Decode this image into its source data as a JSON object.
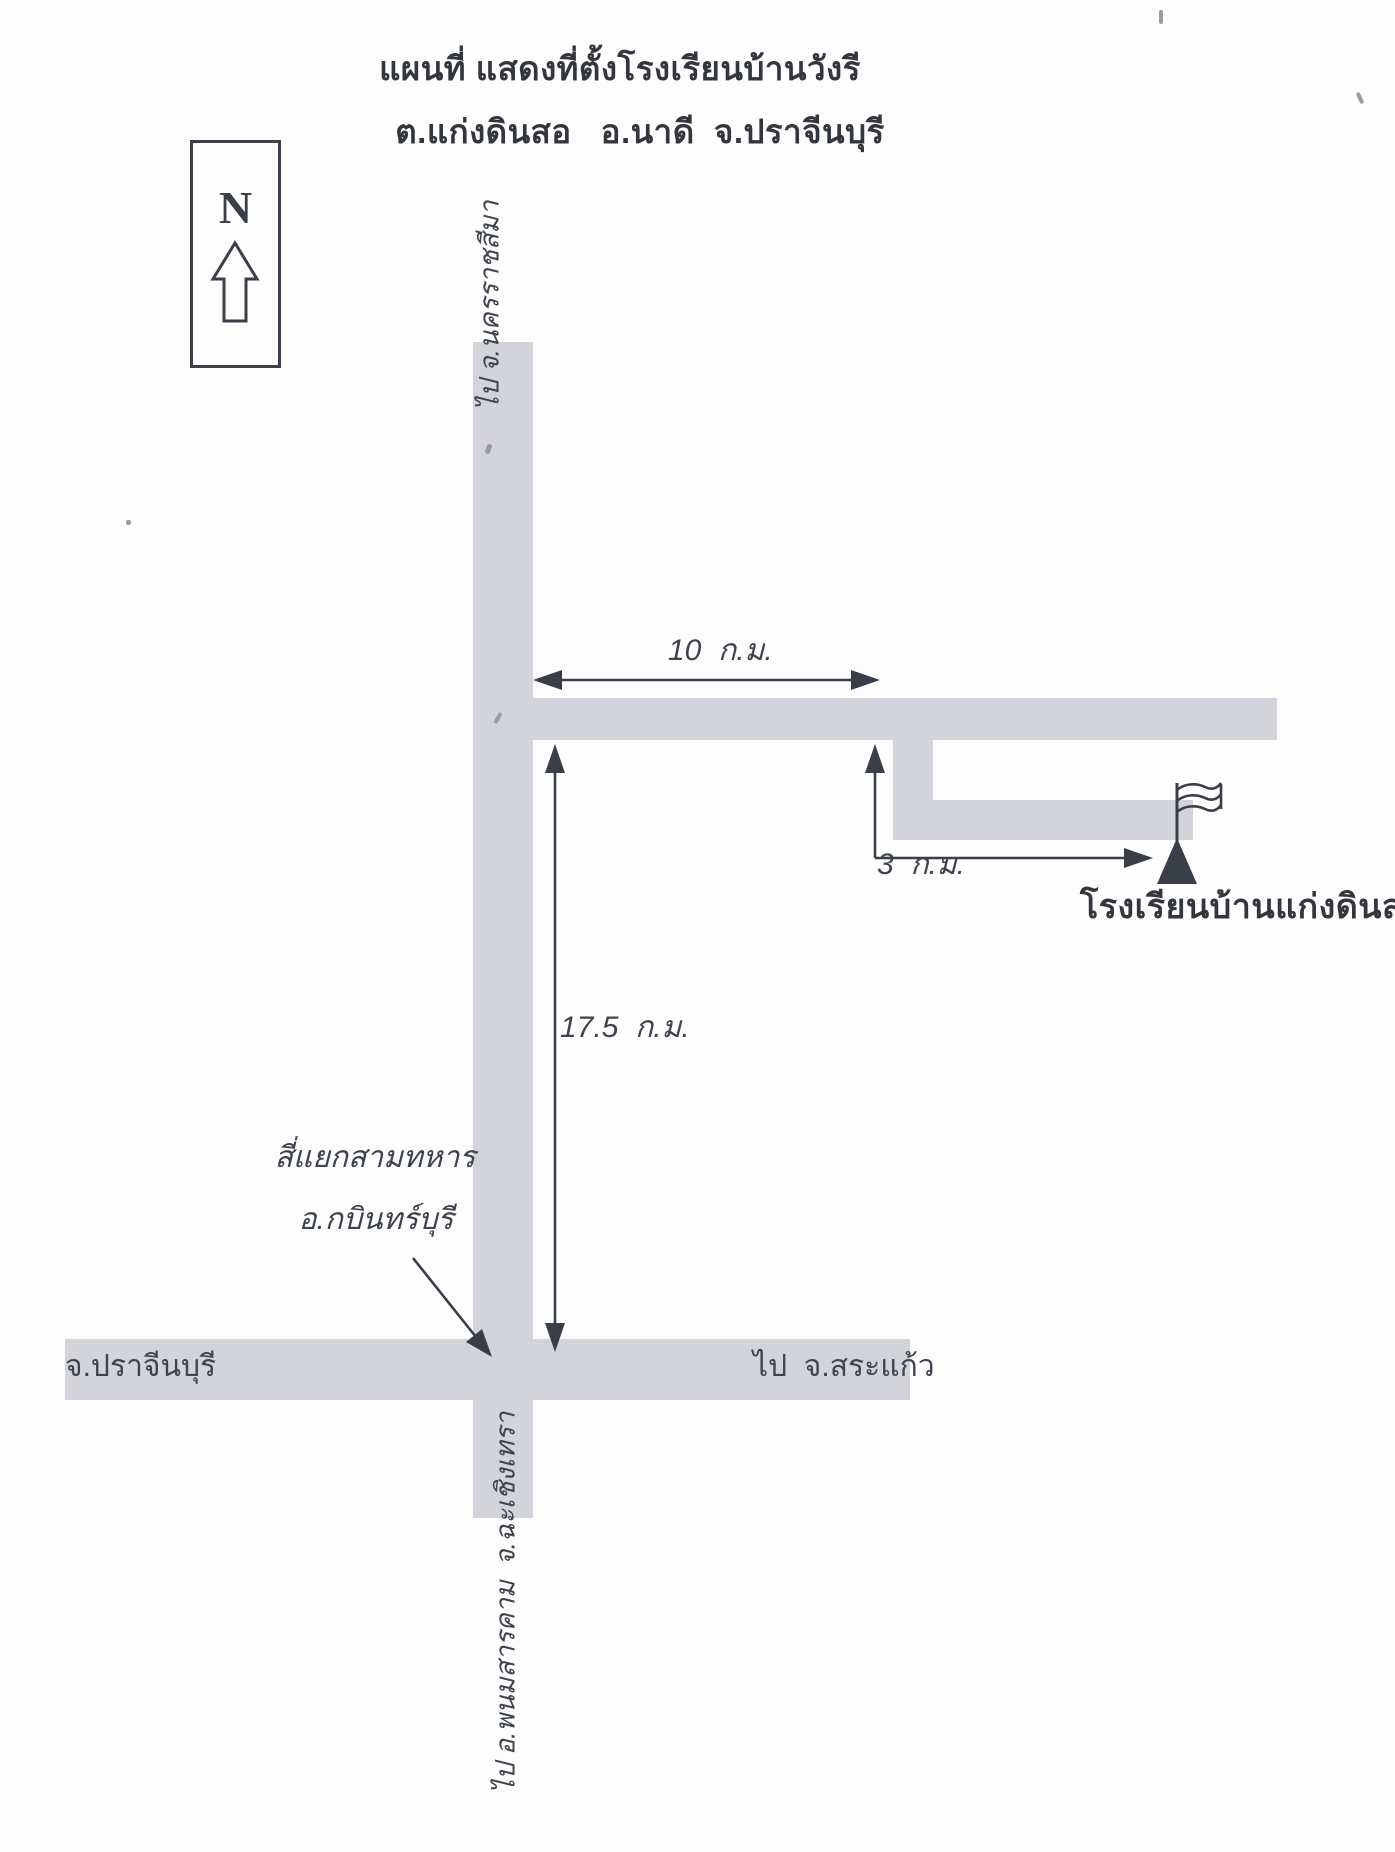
{
  "title": {
    "line1": "แผนที่ แสดงที่ตั้งโรงเรียนบ้านวังรี",
    "line2": "ต.แก่งดินสอ   อ.นาดี  จ.ปราจีนบุรี"
  },
  "compass": {
    "letter": "N",
    "icon": "north-up-arrow-icon"
  },
  "map": {
    "school_marker_icon": "flag-on-triangle-icon",
    "school_label": "โรงเรียนบ้านแก่งดินสอ",
    "distances": {
      "top_road_km": "10  ก.ม.",
      "branch_road_km": "3  ก.ม.",
      "vertical_road_km": "17.5  ก.ม."
    },
    "road_labels": {
      "to_nakhon_ratchasima": "ไป จ.นครราชสีมา",
      "prachinburi": "จ.ปราจีนบุรี",
      "to_sa_kaew": "ไป  จ.สระแก้ว",
      "to_phanom_sarakham": "ไป อ.พนมสารคาม  จ.ฉะเชิงเทรา"
    },
    "junction_label": {
      "line1": "สี่แยกสามทหาร",
      "line2": "อ.กบินทร์บุรี"
    }
  },
  "colors": {
    "road_fill": "#d3d3da",
    "ink": "#3a3e49",
    "title_text": "#33363d",
    "background": "#fdfdfd"
  }
}
